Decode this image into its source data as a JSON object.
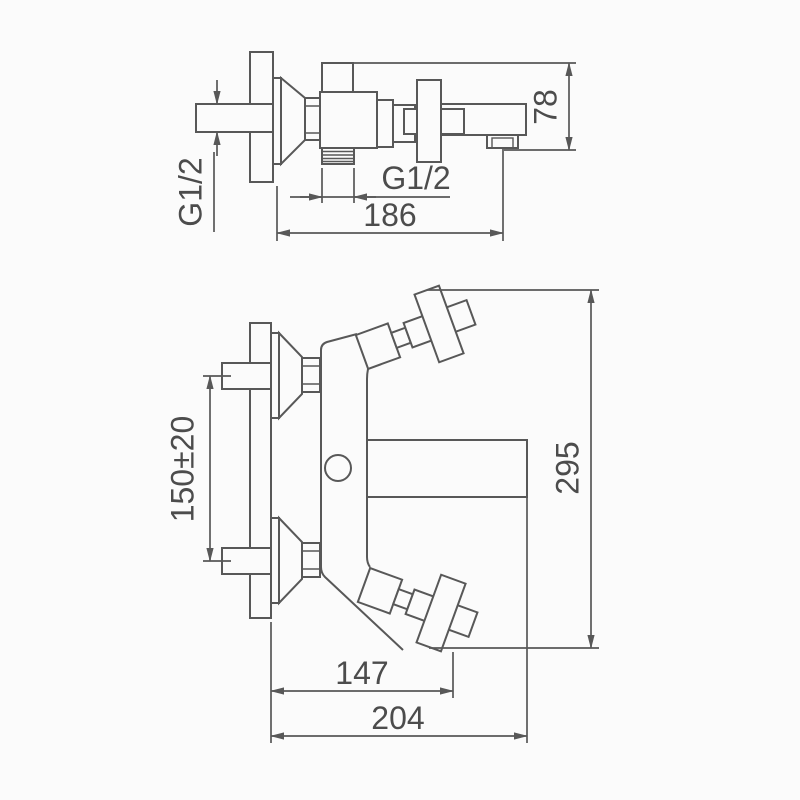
{
  "drawing": {
    "description": "Wall-mounted bath mixer faucet, two-view dimensioned technical drawing",
    "side_view": {
      "wall_thread_label": "G1/2",
      "spout_thread_label": "G1/2",
      "height_dim": "78",
      "reach_dim": "186"
    },
    "front_view": {
      "inlet_spacing_dim": "150±20",
      "height_dim": "295",
      "handle_span_dim": "147",
      "overall_width_dim": "204"
    },
    "colors": {
      "line": "#585858",
      "text": "#4c4c4c",
      "background": "#fbfbfb"
    }
  }
}
